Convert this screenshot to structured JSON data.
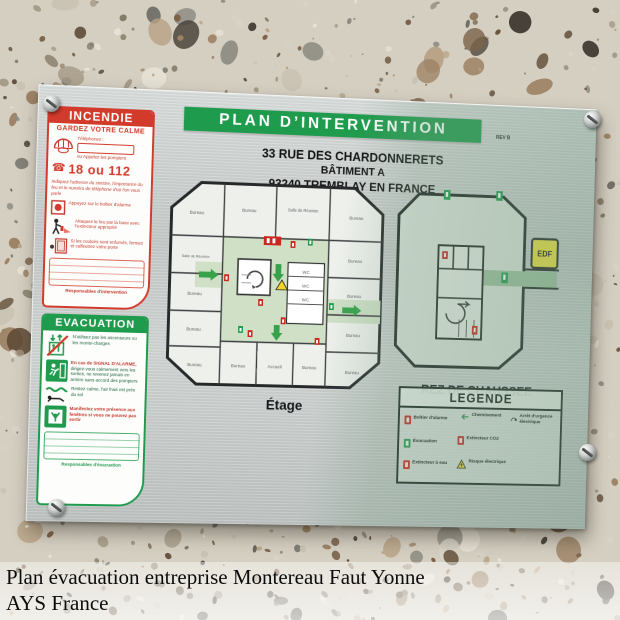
{
  "photo": {
    "caption_line1": "Plan évacuation entreprise Montereau Faut Yonne",
    "caption_line2": "AYS France"
  },
  "plate": {
    "title": "PLAN D’INTERVENTION",
    "rev_note": "REV B",
    "address_line1": "33 RUE DES CHARDONNERETS",
    "address_line2": "BÂTIMENT A",
    "address_line3": "93240 TREMBLAY EN FRANCE",
    "colors": {
      "banner_green": "#1f9b4d",
      "incendie_red": "#d23b2c",
      "plate_silver": "#cdd1d0",
      "tint_green": "#8fae98",
      "edf_yellow": "#efe23b"
    },
    "incendie": {
      "header": "INCENDIE",
      "subheader": "GARDEZ VOTRE CALME",
      "phone_label": "Téléphonez :",
      "call_note": "ou Appelez les pompiers",
      "numbers": "18 ou 112",
      "instruction": "Indiquez l'adresse du sinistre, l'importance du feu et le numéro de téléphone d'où l'on vous parle",
      "step_alarm": "Appuyez sur le boîtier d'alarme",
      "step_extinguisher": "Attaquez le feu par la base avec l'extincteur approprié",
      "step_door": "Si les couloirs sont enfumés, fermez et calfeutrez votre porte",
      "footer": "Responsables d'intervention"
    },
    "evacuation": {
      "header": "EVACUATION",
      "step_elevator": "N'utilisez pas les ascenseurs ou les monte-charges",
      "alarm_intro": "En cas de SIGNAL D'ALARME,",
      "step_exit": "dirigez-vous calmement vers les sorties, ne revenez jamais en arrière sans accord des pompiers",
      "step_crawl": "Restez calme, l'air frais est près du sol",
      "step_window": "Manifestez votre présence aux fenêtres si vous ne pouvez pas sortir",
      "footer": "Responsables d'évacuation"
    },
    "floor_plan_label": "Étage",
    "ground_plan_label": "REZ DE CHAUSSEE",
    "edf_label": "EDF",
    "legend": {
      "header": "LEGENDE",
      "items": [
        {
          "icon": "alarm",
          "label": "Boîtier d'alarme"
        },
        {
          "icon": "evacuation",
          "label": "Évacuation"
        },
        {
          "icon": "water-extinguisher",
          "label": "Extincteur à eau"
        },
        {
          "icon": "route-arrow",
          "label": "Cheminement"
        },
        {
          "icon": "co2-extinguisher",
          "label": "Extincteur CO2"
        },
        {
          "icon": "electrical-hazard",
          "label": "Risque électrique"
        },
        {
          "icon": "emergency-stop",
          "label": "Arrêt d'urgence électrique"
        }
      ]
    },
    "floor_rooms": [
      "Bureau",
      "Bureau",
      "Salle de Réunion",
      "Bureau",
      "Bureau",
      "Bureau",
      "Salle de Réunion",
      "Bureau",
      "Bureau",
      "Bureau",
      "Bureau",
      "Accueil",
      "Bureau",
      "Bureau",
      "Bureau",
      "WC",
      "WC",
      "WC"
    ]
  }
}
